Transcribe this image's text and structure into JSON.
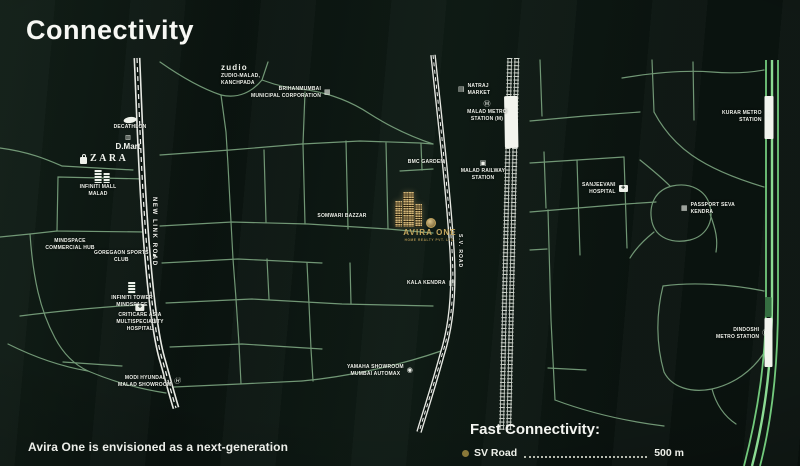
{
  "title": "Connectivity",
  "colors": {
    "background": "#0b1410",
    "street_green": "#7fa983",
    "highway_green": "#72c97c",
    "road_white": "#e7e9e3",
    "gold_accent": "#c4a75f",
    "bullet_gold": "#8a7839",
    "label_white": "#eef1ea"
  },
  "roads": {
    "new_link": "NEW LINK ROAD",
    "sv": "S.V. ROAD"
  },
  "icons": {
    "building": "▦",
    "market": "▤",
    "metro": "Ⓜ",
    "railway": "▣",
    "hospital": "✚",
    "flag": "⚑",
    "circle": "◉",
    "hyundai": "Ⓗ",
    "cart": "▥"
  },
  "pois": [
    {
      "id": "zudio",
      "logo": "zudio",
      "label": "ZUDIO-MALAD,\nKANCHPADA"
    },
    {
      "id": "brihanmumbai",
      "label": "BRIHANMUMBAI\nMUNICIPAL CORPORATION"
    },
    {
      "id": "natraj-market",
      "label": "NATRAJ\nMARKET"
    },
    {
      "id": "malad-metro",
      "label": "MALAD METRO\nSTATION (M)"
    },
    {
      "id": "bmc-garden",
      "label": "BMC GARDEN"
    },
    {
      "id": "malad-railway",
      "label": "MALAD RAILWAY\nSTATION"
    },
    {
      "id": "kurar-metro",
      "label": "KURAR METRO\nSTATION"
    },
    {
      "id": "sanjeevani",
      "label": "SANJEEVANI\nHOSPITAL"
    },
    {
      "id": "passport-seva",
      "label": "PASSPORT SEVA\nKENDRA"
    },
    {
      "id": "somwari-bazzar",
      "label": "SOMWARI BAZZAR"
    },
    {
      "id": "kala-kendra",
      "label": "KALA KENDRA"
    },
    {
      "id": "dindoshi-metro",
      "label": "DINDOSHI\nMETRO STATION"
    },
    {
      "id": "decathlon",
      "label": "DECATHLON"
    },
    {
      "id": "dmart",
      "brand": "D.Mart"
    },
    {
      "id": "zara",
      "brand": "ZARA"
    },
    {
      "id": "infiniti-mall",
      "label": "INFINITI MALL\nMALAD"
    },
    {
      "id": "mindspace-hub",
      "label": "MINDSPACE\nCOMMERCIAL HUB"
    },
    {
      "id": "goregaon-sports",
      "label": "GOREGAON SPORTS\nCLUB"
    },
    {
      "id": "infiniti-tower",
      "label": "INFINITI TOWER\nMINDSPACE"
    },
    {
      "id": "criticare",
      "label": "CRITICARE ASIA\nMULTISPECIALITY\nHOSPITAL"
    },
    {
      "id": "modi-hyundai",
      "label": "MODI HYUNDAI\nMALAD SHOWROOM"
    },
    {
      "id": "yamaha",
      "label": "YAMAHA SHOWROOM\nMUMBAI AUTOMAX"
    }
  ],
  "avira": {
    "name": "AVIRA ONE",
    "tagline": "HOME REALTY PVT. LTD."
  },
  "footer": {
    "paragraph": "Avira One is envisioned as a next-generation"
  },
  "fast_connectivity": {
    "heading": "Fast Connectivity:",
    "items": [
      {
        "label": "SV Road",
        "value": "500 m"
      }
    ]
  }
}
